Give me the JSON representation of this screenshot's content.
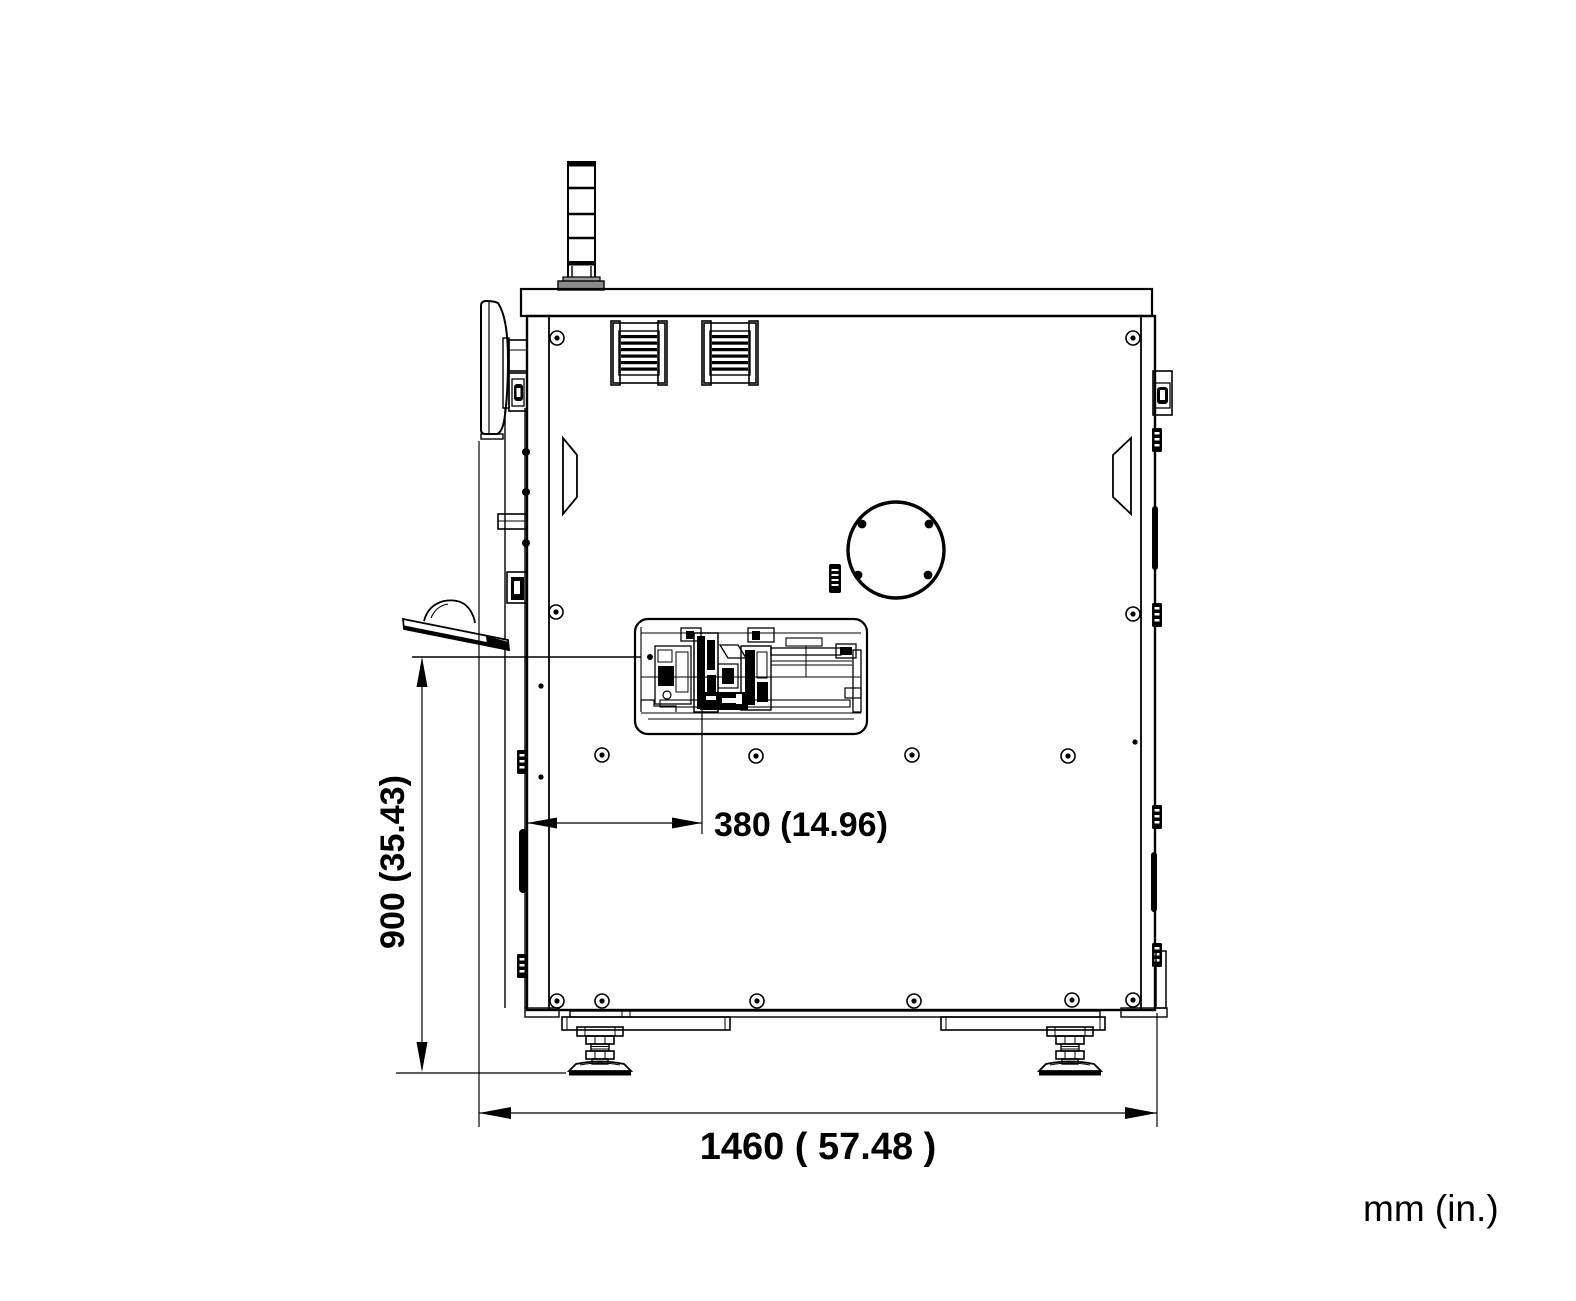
{
  "drawing": {
    "units_label": "mm (in.)",
    "dimensions": {
      "height": {
        "label": "900 (35.43)",
        "mm": "900",
        "in": "35.43",
        "orientation": "vertical"
      },
      "mechanism_offset": {
        "label": "380 (14.96)",
        "mm": "380",
        "in": "14.96",
        "orientation": "horizontal"
      },
      "depth": {
        "label": "1460 ( 57.48 )",
        "mm": "1460",
        "in": "57.48",
        "orientation": "horizontal"
      }
    },
    "colors": {
      "line": "#000000",
      "background": "#ffffff",
      "flange_gray": "#8a8a8a"
    }
  }
}
